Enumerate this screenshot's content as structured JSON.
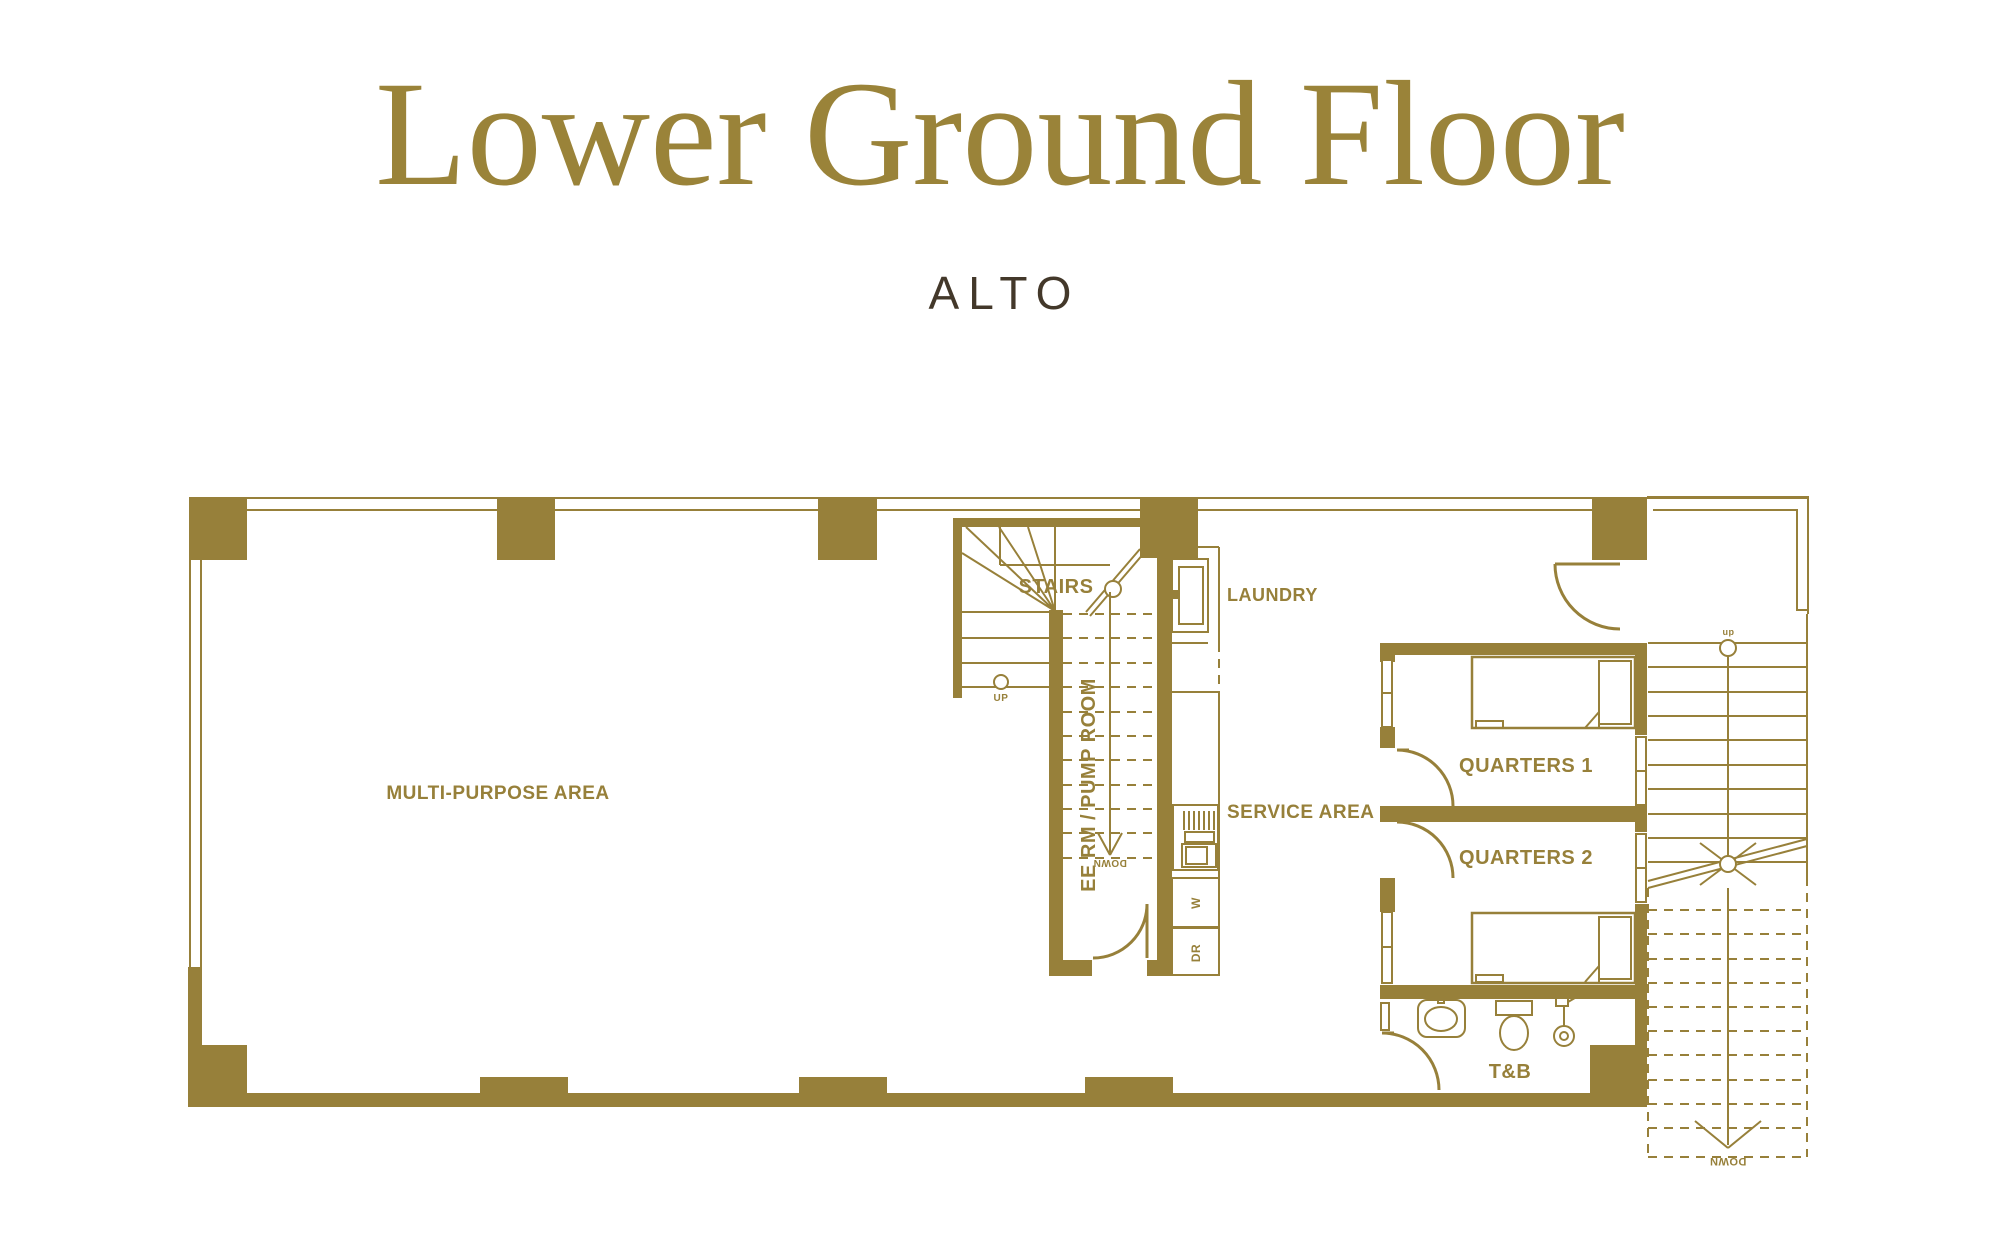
{
  "title": "Lower Ground Floor",
  "subtitle": "ALTO",
  "colors": {
    "gold": "#97803A",
    "title_gold": "#9A8339",
    "subtitle_brown": "#43382A"
  },
  "rooms": {
    "multi_purpose": "MULTI-PURPOSE AREA",
    "stairs": "STAIRS",
    "laundry": "LAUNDRY",
    "ee_pump_room": "EE RM / PUMP ROOM",
    "service_area": "SERVICE AREA",
    "quarters1": "QUARTERS 1",
    "quarters2": "QUARTERS 2",
    "toilet_bath": "T&B"
  },
  "annotations": {
    "up": "UP",
    "down_pump_stair": "DOWN",
    "down_right_stair": "DOWN",
    "dn_marker": "dn",
    "washer": "W",
    "dryer": "DR"
  }
}
